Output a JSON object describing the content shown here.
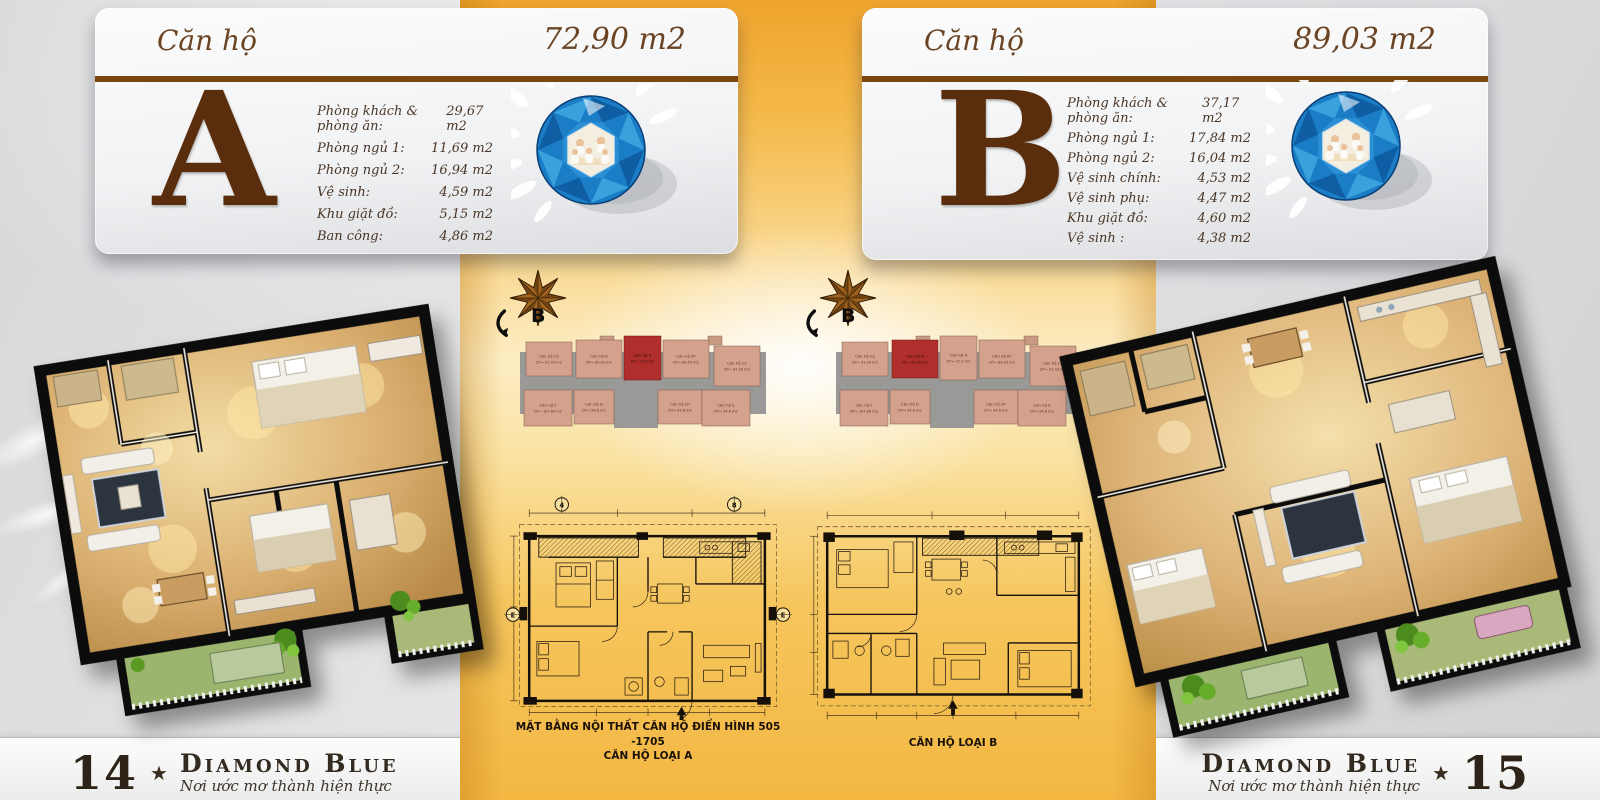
{
  "colors": {
    "accent_rule_brown": "#7a4710",
    "letter_brown": "#5a2d0c",
    "band_orange": "#f2ab38",
    "unit_fill_salmon": "#d4a18c",
    "unit_highlight_red": "#b02f2c",
    "gem_blue": "#1b7dc6"
  },
  "cards": {
    "a": {
      "title": "Căn hộ",
      "area": "72,90 m2",
      "letter": "A",
      "rooms": [
        {
          "label": "Phòng khách & phòng ăn:",
          "value": "29,67 m2"
        },
        {
          "label": "Phòng ngủ 1:",
          "value": "11,69 m2"
        },
        {
          "label": "Phòng ngủ 2:",
          "value": "16,94 m2"
        },
        {
          "label": "Vệ sinh:",
          "value": "4,59 m2"
        },
        {
          "label": "Khu giặt đồ:",
          "value": "5,15 m2"
        },
        {
          "label": "Ban công:",
          "value": "4,86 m2"
        }
      ]
    },
    "b": {
      "title": "Căn hộ",
      "area": "89,03 m2",
      "letter": "B",
      "rooms": [
        {
          "label": "Phòng khách & phòng ăn:",
          "value": "37,17 m2"
        },
        {
          "label": "Phòng ngủ 1:",
          "value": "17,84 m2"
        },
        {
          "label": "Phòng ngủ 2:",
          "value": "16,04 m2"
        },
        {
          "label": "Vệ sinh chính:",
          "value": "4,53 m2"
        },
        {
          "label": "Vệ sinh phụ:",
          "value": "4,47 m2"
        },
        {
          "label": "Khu giặt đồ:",
          "value": "4,60 m2"
        },
        {
          "label": "Vệ sinh :",
          "value": "4,38 m2"
        }
      ]
    }
  },
  "site_plans": {
    "compass_label": "B",
    "plan1": {
      "highlighted_unit": "A",
      "units_top": [
        {
          "name": "Căn hộ C2",
          "area": "DT= 91,43 m2"
        },
        {
          "name": "Căn hộ B",
          "area": "DT= 89,03 m2"
        },
        {
          "name": "Căn hộ A",
          "area": "DT= 72,9 m2"
        },
        {
          "name": "Căn hộ B*",
          "area": "DT= 89,03 m2"
        },
        {
          "name": "Căn hộ C1",
          "area": "DT= 91,43 m2"
        }
      ],
      "units_bottom": [
        {
          "name": "Căn hộ F",
          "area": "DT= 107,69 m2"
        },
        {
          "name": "Căn hộ D",
          "area": "DT= 94,6 m2"
        },
        {
          "name": "Căn hộ D*",
          "area": "DT= 94,6 m2"
        },
        {
          "name": "Căn hộ E",
          "area": "DT= 94,6 m2"
        }
      ]
    },
    "plan2": {
      "highlighted_unit": "B",
      "units_top": [
        {
          "name": "Căn hộ C2",
          "area": "DT= 91,43 m2"
        },
        {
          "name": "Căn hộ B",
          "area": "DT= 89,03 m2"
        },
        {
          "name": "Căn hộ A",
          "area": "DT= 72,9 m2"
        },
        {
          "name": "Căn hộ B*",
          "area": "DT= 89,03 m2"
        },
        {
          "name": "Căn hộ C1",
          "area": "DT= 91,43 m2"
        }
      ],
      "units_bottom": [
        {
          "name": "Căn hộ F",
          "area": "DT= 107,69 m2"
        },
        {
          "name": "Căn hộ D",
          "area": "DT= 94,6 m2"
        },
        {
          "name": "Căn hộ D*",
          "area": "DT= 94,6 m2"
        },
        {
          "name": "Căn hộ E",
          "area": "DT= 94,6 m2"
        }
      ]
    }
  },
  "floor_plans": {
    "a": {
      "caption1": "MẶT BẰNG NỘI THẤT CĂN HỘ ĐIỂN HÌNH 505 -1705",
      "caption2": "CĂN HỘ LOẠI A",
      "grid_markers": [
        "4",
        "8",
        "E",
        "E"
      ]
    },
    "b": {
      "caption": "CĂN HỘ LOẠI B"
    }
  },
  "footer_left": {
    "page_number": "14",
    "star": "★",
    "brand": "Diamond Blue",
    "tagline": "Nơi ước mơ thành hiện thực"
  },
  "footer_right": {
    "page_number": "15",
    "star": "★",
    "brand": "Diamond Blue",
    "tagline": "Nơi ước mơ thành hiện thực"
  }
}
